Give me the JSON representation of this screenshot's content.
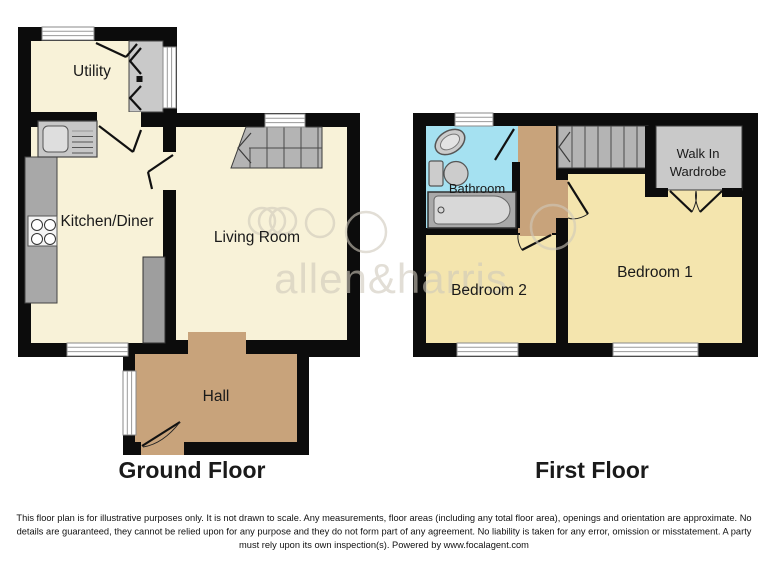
{
  "watermark": {
    "logo_text": "allen&harris"
  },
  "ground_floor": {
    "title": "Ground Floor",
    "rooms": {
      "utility": "Utility",
      "kitchen_diner": "Kitchen/Diner",
      "living_room": "Living Room",
      "hall": "Hall"
    }
  },
  "first_floor": {
    "title": "First Floor",
    "rooms": {
      "bathroom": "Bathroom",
      "bedroom2": "Bedroom 2",
      "bedroom1": "Bedroom 1",
      "walk_in_wardrobe_line1": "Walk In",
      "walk_in_wardrobe_line2": "Wardrobe"
    }
  },
  "disclaimer": {
    "line1": "This floor plan is for illustrative purposes only. It is not drawn to scale. Any measurements, floor areas (including any total floor area), openings and orientation are approximate. No",
    "line2": "details are guaranteed, they cannot be relied upon for any purpose and they do not form part of any agreement. No liability is taken for any error, omission or misstatement. A party",
    "line3": "must rely upon its own inspection(s). Powered by www.focalagent.com"
  },
  "colors": {
    "wall": "#0c0c0c",
    "ground_floor_rooms": "#f8f2d8",
    "bedrooms": "#f4e5ae",
    "hall_landing": "#c8a37b",
    "bathroom": "#a5e1f1",
    "stairs": "#b4b4b4",
    "wardrobe": "#c9c9c9",
    "watermark": "#cfc9bb"
  }
}
